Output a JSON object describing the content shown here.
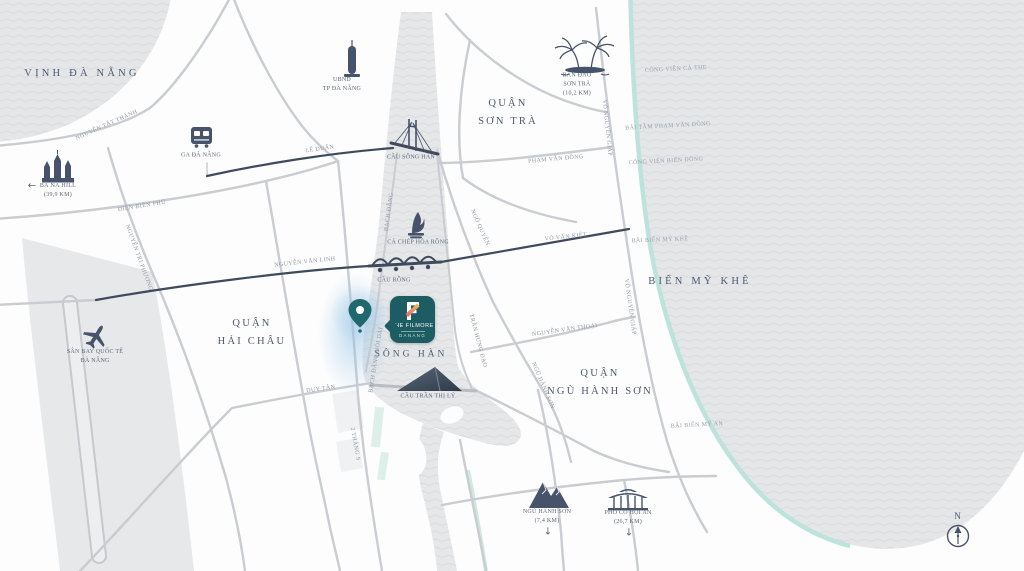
{
  "title": "The Filmore Da Nang location map",
  "project": {
    "logo_letter": "F",
    "name": "THE FILMORE",
    "subtitle": "DANANG"
  },
  "compass": {
    "north": "N"
  },
  "colors": {
    "brand_teal": "#1d5c63",
    "pin_teal": "#20686d",
    "coastline_teal": "#b9e3da",
    "water_fill": "#e4e6e8",
    "road_gray": "#c9ccd0",
    "road_dark": "#3f4b5d",
    "icon_slate": "#47536a",
    "label_navy": "#4d5870",
    "road_label_gray": "#8e96a3",
    "logo_gradient_start": "#f2bf4f",
    "logo_gradient_end": "#e2607e",
    "glow_blue": "#96c4e6"
  },
  "icons": [
    "location-pin-icon",
    "train-station-icon",
    "bana-castle-icon",
    "airplane-icon",
    "palm-island-icon",
    "mountains-icon",
    "hoian-bridge-icon",
    "han-river-bridge-icon",
    "dragon-bridge-icon",
    "sail-bridge-icon",
    "carp-dragon-statue-icon",
    "city-hall-tower-icon",
    "compass-north-icon",
    "left-arrow-icon",
    "down-arrow-icon"
  ],
  "labels": [
    {
      "id": "vinh-da-nang",
      "text": "VỊNH ĐÀ NẴNG",
      "x": 82,
      "y": 74,
      "rot": 0,
      "cls": "water-lg"
    },
    {
      "id": "bien-my-khe",
      "text": "BIỂN MỸ KHÊ",
      "x": 700,
      "y": 282,
      "rot": 0,
      "cls": "water-lg"
    },
    {
      "id": "song-han",
      "text": "SÔNG HÀN",
      "x": 411,
      "y": 355,
      "rot": 0,
      "cls": "water-md"
    },
    {
      "id": "quan-son-tra",
      "text": "QUẬN\nSƠN TRÀ",
      "x": 508,
      "y": 113,
      "rot": 0,
      "cls": "district"
    },
    {
      "id": "quan-hai-chau",
      "text": "QUẬN\nHẢI CHÂU",
      "x": 252,
      "y": 333,
      "rot": 0,
      "cls": "district"
    },
    {
      "id": "quan-ngu-hanh-son",
      "text": "QUẬN\nNGŨ HÀNH SƠN",
      "x": 600,
      "y": 383,
      "rot": 0,
      "cls": "district"
    },
    {
      "id": "nguyen-tat-thanh",
      "text": "NGUYỄN TẤT THÀNH",
      "x": 107,
      "y": 126,
      "rot": -24,
      "cls": "road"
    },
    {
      "id": "le-duan",
      "text": "LÊ DUẨN",
      "x": 320,
      "y": 150,
      "rot": -8,
      "cls": "road"
    },
    {
      "id": "dien-bien-phu",
      "text": "ĐIỆN BIÊN PHỦ",
      "x": 142,
      "y": 207,
      "rot": -9,
      "cls": "road"
    },
    {
      "id": "nguyen-tri-phuong",
      "text": "NGUYỄN TRI PHƯƠNG",
      "x": 138,
      "y": 258,
      "rot": 70,
      "cls": "road"
    },
    {
      "id": "nguyen-van-linh",
      "text": "NGUYỄN VĂN LINH",
      "x": 305,
      "y": 263,
      "rot": -6,
      "cls": "road"
    },
    {
      "id": "vo-van-kiet",
      "text": "VÕ VĂN KIỆT",
      "x": 566,
      "y": 238,
      "rot": -6,
      "cls": "road"
    },
    {
      "id": "duy-tan",
      "text": "DUY TÂN",
      "x": 321,
      "y": 390,
      "rot": -8,
      "cls": "road"
    },
    {
      "id": "bach-dang",
      "text": "BẠCH ĐẰNG",
      "x": 390,
      "y": 212,
      "rot": -82,
      "cls": "road"
    },
    {
      "id": "bach-dang-noi-dai",
      "text": "BẠCH ĐẰNG NỐI DÀI",
      "x": 377,
      "y": 360,
      "rot": -81,
      "cls": "road"
    },
    {
      "id": "hai-thang-chin",
      "text": "2 THÁNG 9",
      "x": 354,
      "y": 444,
      "rot": 80,
      "cls": "road"
    },
    {
      "id": "tran-hung-dao",
      "text": "TRẦN HƯNG ĐẠO",
      "x": 477,
      "y": 341,
      "rot": 75,
      "cls": "road"
    },
    {
      "id": "ngo-quyen",
      "text": "NGÔ QUYỀN",
      "x": 479,
      "y": 228,
      "rot": 66,
      "cls": "road"
    },
    {
      "id": "ngu-hanh-son-street",
      "text": "NGŨ HÀNH SƠN",
      "x": 542,
      "y": 386,
      "rot": 67,
      "cls": "road"
    },
    {
      "id": "vo-nguyen-giap-north",
      "text": "VÕ NGUYÊN GIÁP",
      "x": 606,
      "y": 128,
      "rot": 84,
      "cls": "road"
    },
    {
      "id": "vo-nguyen-giap-south",
      "text": "VÕ NGUYÊN GIÁP",
      "x": 629,
      "y": 307,
      "rot": 82,
      "cls": "road"
    },
    {
      "id": "pham-van-dong",
      "text": "PHẠM VĂN ĐỒNG",
      "x": 556,
      "y": 160,
      "rot": -5,
      "cls": "road"
    },
    {
      "id": "nguyen-van-thoai",
      "text": "NGUYỄN VĂN THOẠI",
      "x": 565,
      "y": 331,
      "rot": -8,
      "cls": "road"
    },
    {
      "id": "cau-song-han",
      "text": "CẦU SÔNG HÀN",
      "x": 411,
      "y": 158,
      "rot": 0,
      "cls": "poi"
    },
    {
      "id": "cau-rong",
      "text": "CẦU RỒNG",
      "x": 394,
      "y": 281,
      "rot": 0,
      "cls": "poi"
    },
    {
      "id": "ca-chep-hoa-rong",
      "text": "CÁ CHÉP HÓA RỒNG",
      "x": 418,
      "y": 243,
      "rot": 0,
      "cls": "poi"
    },
    {
      "id": "cau-tran-thi-ly",
      "text": "CẦU TRẦN THỊ LÝ",
      "x": 428,
      "y": 397,
      "rot": 0,
      "cls": "poi"
    },
    {
      "id": "ga-da-nang",
      "text": "GA ĐÀ NẴNG",
      "x": 201,
      "y": 156,
      "rot": 0,
      "cls": "poi"
    },
    {
      "id": "ubnd-tp-da-nang",
      "text": "UBND\nTP ĐÀ NẴNG",
      "x": 342,
      "y": 85,
      "rot": 0,
      "cls": "poi"
    },
    {
      "id": "ba-na-hill",
      "text": "BÀ NÀ HILL\n(39,9 KM)",
      "x": 58,
      "y": 191,
      "rot": 0,
      "cls": "poi"
    },
    {
      "id": "san-bay-quoc-te",
      "text": "SÂN BAY QUỐC TẾ\nĐÀ NẴNG",
      "x": 95,
      "y": 357,
      "rot": 0,
      "cls": "poi"
    },
    {
      "id": "ban-dao-son-tra",
      "text": "BÁN ĐẢO\nSƠN TRÀ\n(10,2 KM)",
      "x": 577,
      "y": 85,
      "rot": 0,
      "cls": "poi"
    },
    {
      "id": "ngu-hanh-son-poi",
      "text": "NGŨ HÀNH SƠN\n(7,4 KM)",
      "x": 547,
      "y": 517,
      "rot": 0,
      "cls": "poi"
    },
    {
      "id": "pho-co-hoi-an",
      "text": "PHỐ CỔ HỘI AN\n(26,7 KM)",
      "x": 628,
      "y": 518,
      "rot": 0,
      "cls": "poi"
    },
    {
      "id": "cong-vien-ca-the",
      "text": "CÔNG VIÊN CÁ THE",
      "x": 676,
      "y": 70,
      "rot": -3,
      "cls": "coast"
    },
    {
      "id": "bai-tam-pham-van-dong",
      "text": "BÃI TẮM PHẠM VĂN ĐỒNG",
      "x": 668,
      "y": 127,
      "rot": -3,
      "cls": "coast"
    },
    {
      "id": "cong-vien-bien-dong",
      "text": "CÔNG VIÊN BIỂN ĐÔNG",
      "x": 666,
      "y": 162,
      "rot": -3,
      "cls": "coast"
    },
    {
      "id": "bai-bien-my-khe",
      "text": "BÃI BIỂN MỸ KHÊ",
      "x": 660,
      "y": 241,
      "rot": -2,
      "cls": "coast"
    },
    {
      "id": "bai-bien-my-an",
      "text": "BÃI BIỂN MỸ AN",
      "x": 697,
      "y": 426,
      "rot": -3,
      "cls": "coast"
    },
    {
      "id": "ba-na-arrow",
      "text": "←",
      "x": 32,
      "y": 186,
      "rot": 0,
      "cls": "arrow"
    },
    {
      "id": "ngu-hanh-son-arrow",
      "text": "↓",
      "x": 548,
      "y": 532,
      "rot": 0,
      "cls": "arrow"
    },
    {
      "id": "hoi-an-arrow",
      "text": "↓",
      "x": 629,
      "y": 533,
      "rot": 0,
      "cls": "arrow"
    }
  ]
}
